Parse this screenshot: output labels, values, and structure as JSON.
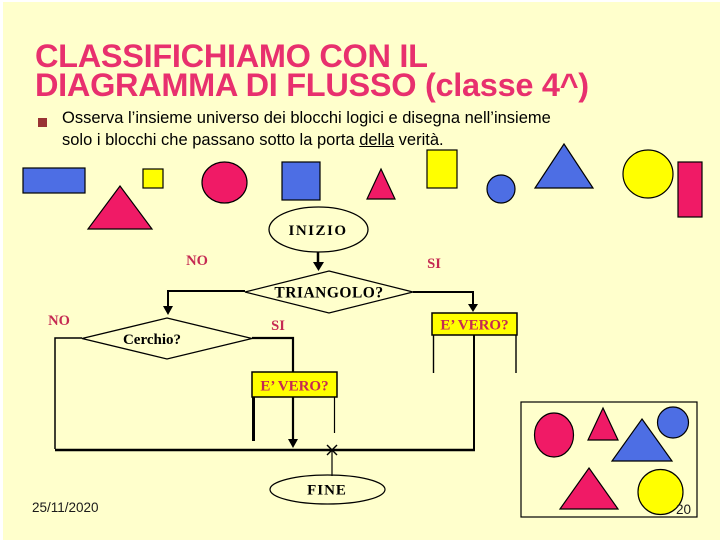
{
  "slide": {
    "title_line1": "CLASSIFICHIAMO CON IL",
    "title_line2": "DIAGRAMMA DI FLUSSO (classe 4^)",
    "bullet": {
      "line1": "Osserva l’insieme universo dei blocchi logici e disegna nell’insieme",
      "line2_before": "solo i blocchi che passano sotto la porta ",
      "line2_underlined": "della",
      "line2_after": " verità."
    },
    "footer": {
      "date": "25/11/2020",
      "page_number": "20"
    }
  },
  "flowchart": {
    "start_label": "INIZIO",
    "decision1_label": "TRIANGOLO?",
    "decision1_no": "NO",
    "decision1_si": "SI",
    "decision2_label": "Cerchio?",
    "decision2_no": "NO",
    "decision2_si": "SI",
    "truth_gate_left_label": "E’ VERO?",
    "truth_gate_right_label": "E’ VERO?",
    "end_label": "FINE"
  },
  "universe_shapes": [
    {
      "shape": "rectangle",
      "color": "blue"
    },
    {
      "shape": "triangle",
      "color": "magenta"
    },
    {
      "shape": "square",
      "color": "yellow"
    },
    {
      "shape": "circle",
      "color": "magenta"
    },
    {
      "shape": "square",
      "color": "blue"
    },
    {
      "shape": "triangle",
      "color": "magenta"
    },
    {
      "shape": "rectangle",
      "color": "yellow"
    },
    {
      "shape": "circle",
      "color": "blue"
    },
    {
      "shape": "triangle",
      "color": "blue"
    },
    {
      "shape": "circle",
      "color": "yellow"
    },
    {
      "shape": "rectangle",
      "color": "magenta"
    }
  ],
  "result_box_shapes": [
    {
      "shape": "circle",
      "color": "magenta"
    },
    {
      "shape": "triangle",
      "color": "magenta"
    },
    {
      "shape": "triangle",
      "color": "blue"
    },
    {
      "shape": "circle",
      "color": "blue"
    },
    {
      "shape": "triangle",
      "color": "magenta"
    },
    {
      "shape": "circle",
      "color": "yellow"
    }
  ],
  "palette": {
    "background": "#FFFFCC",
    "title": "#E8306E",
    "magenta": "#F01A66",
    "blue": "#4D6EE4",
    "yellow": "#FFFF00",
    "label_red": "#C52A52",
    "bullet": "#993333",
    "text": "#000000"
  }
}
